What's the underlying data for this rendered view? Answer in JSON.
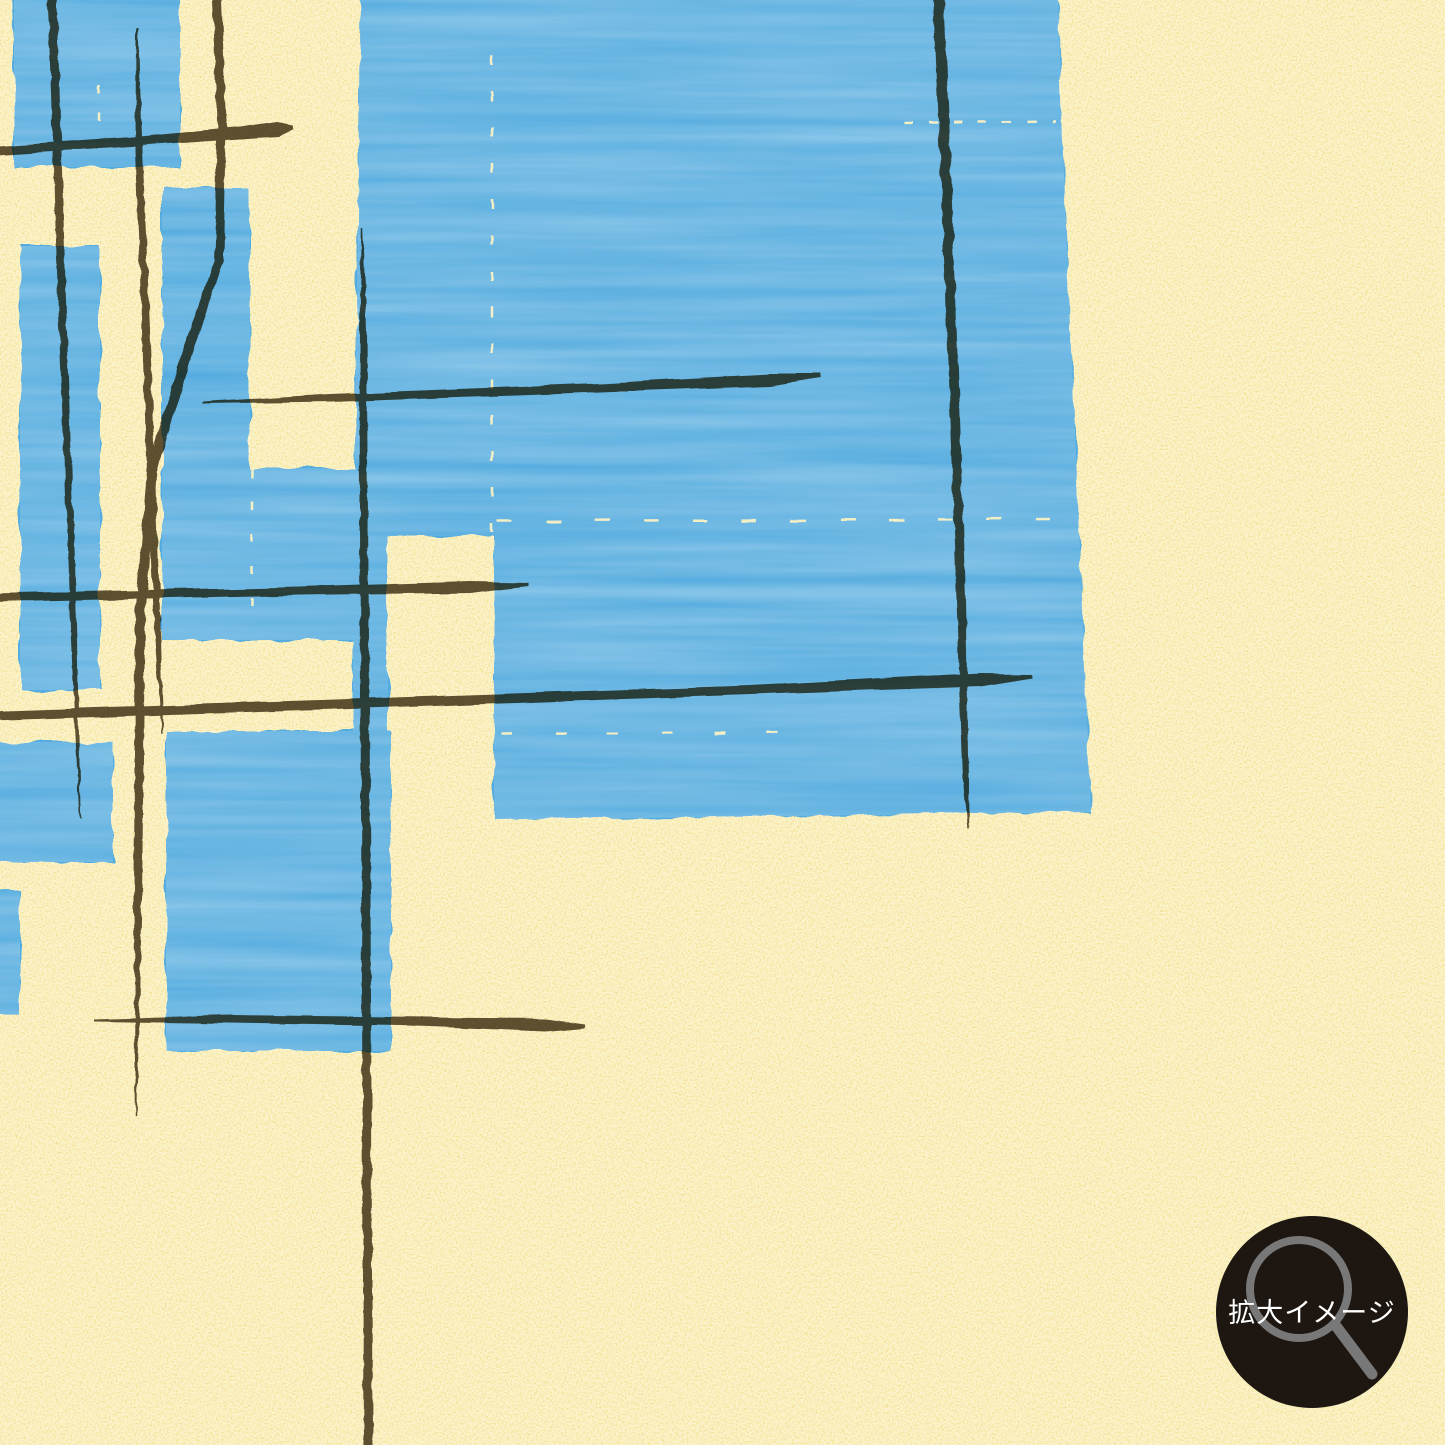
{
  "image": {
    "kind": "abstract-pattern-artwork-enlarged-view"
  },
  "badge": {
    "label": "拡大イメージ",
    "icon": "magnifier-icon",
    "bg_color": "#1e1711",
    "glass_color": "#818181",
    "text_color": "#ffffff",
    "cx": 1312,
    "cy": 1312,
    "r": 96
  },
  "art": {
    "background": "#f0d87c",
    "speckle_light": "#fdf4bc",
    "speckle_dark": "#e2c45e",
    "blue": "#55acdf",
    "line_color": "#5e5440",
    "crack_color": "#fbf2c4",
    "blue_shapes": [
      {
        "name": "blue-field-top-right",
        "d": "M360,-8 L1058,-8 L1065,200 L1075,430 L1083,620 L1091,812 L494,820 L494,536 L388,536 L388,819 L353,819 L353,533 L358,220 Z"
      },
      {
        "name": "blue-rect-top-left",
        "d": "M14,-8 L180,-8 L180,167 L14,167 Z"
      },
      {
        "name": "blue-rect-left-tall",
        "d": "M20,246 L100,246 L100,690 L20,690 Z"
      },
      {
        "name": "blue-rect-center-column",
        "d": "M162,187 L250,187 L250,468 L356,468 L356,640 L162,640 Z"
      },
      {
        "name": "blue-rect-bottom-left",
        "d": "M166,731 L391,731 L391,1051 L166,1051 Z"
      },
      {
        "name": "blue-rect-left-edge",
        "d": "M-8,742 L113,742 L113,862 L-8,862 Z"
      },
      {
        "name": "blue-sliver-left-edge",
        "d": "M-8,889 L20,889 L20,1014 L-8,1014 Z"
      }
    ],
    "brush_lines": [
      {
        "name": "brush-vline-1",
        "pts": [
          [
            52,
            -10,
            9
          ],
          [
            62,
            300,
            8
          ],
          [
            74,
            640,
            6
          ],
          [
            80,
            818,
            1.5
          ]
        ]
      },
      {
        "name": "brush-vline-2",
        "pts": [
          [
            137,
            28,
            2
          ],
          [
            139,
            150,
            7
          ],
          [
            146,
            330,
            8
          ],
          [
            152,
            500,
            8
          ],
          [
            158,
            640,
            6
          ],
          [
            163,
            735,
            1.5
          ]
        ]
      },
      {
        "name": "brush-vline-3",
        "pts": [
          [
            216,
            -10,
            9
          ],
          [
            222,
            120,
            9
          ],
          [
            219,
            260,
            9
          ],
          [
            185,
            360,
            10
          ],
          [
            152,
            470,
            10
          ],
          [
            140,
            620,
            10
          ],
          [
            138,
            900,
            8
          ],
          [
            136,
            1117,
            1.5
          ]
        ]
      },
      {
        "name": "brush-vline-4",
        "pts": [
          [
            362,
            227,
            1.5
          ],
          [
            363,
            330,
            7
          ],
          [
            365,
            700,
            9
          ],
          [
            367,
            1100,
            9
          ],
          [
            368,
            1455,
            9
          ]
        ]
      },
      {
        "name": "brush-vline-5",
        "pts": [
          [
            938,
            -10,
            11
          ],
          [
            950,
            280,
            10
          ],
          [
            961,
            600,
            9
          ],
          [
            966,
            780,
            6
          ],
          [
            968,
            828,
            1.5
          ]
        ]
      },
      {
        "name": "brush-hline-1",
        "pts": [
          [
            -10,
            151,
            8
          ],
          [
            140,
            141,
            9
          ],
          [
            240,
            133,
            11
          ],
          [
            278,
            129,
            14
          ],
          [
            293,
            127,
            4
          ]
        ]
      },
      {
        "name": "brush-hline-2",
        "pts": [
          [
            203,
            403,
            2
          ],
          [
            330,
            398,
            8
          ],
          [
            600,
            388,
            9
          ],
          [
            770,
            380,
            12
          ],
          [
            820,
            376,
            4
          ]
        ]
      },
      {
        "name": "brush-hline-3",
        "pts": [
          [
            -10,
            598,
            8
          ],
          [
            300,
            591,
            8
          ],
          [
            470,
            587,
            11
          ],
          [
            528,
            584,
            3
          ]
        ]
      },
      {
        "name": "brush-hline-4",
        "pts": [
          [
            -10,
            716,
            10
          ],
          [
            350,
            704,
            10
          ],
          [
            750,
            690,
            9
          ],
          [
            980,
            680,
            13
          ],
          [
            1033,
            676,
            4
          ]
        ]
      },
      {
        "name": "brush-hline-5",
        "pts": [
          [
            94,
            1020,
            2
          ],
          [
            230,
            1019,
            8
          ],
          [
            430,
            1022,
            9
          ],
          [
            545,
            1025,
            13
          ],
          [
            584,
            1026,
            4
          ]
        ]
      }
    ],
    "dash_marks": [
      {
        "name": "crack-vertical-1",
        "d": "M492,55 L492,532",
        "dash": "10 26",
        "width": 2.5
      },
      {
        "name": "crack-horizontal-1",
        "d": "M497,521 L1054,519",
        "dash": "15 34",
        "width": 2.5
      },
      {
        "name": "crack-horizontal-2",
        "d": "M903,123 L1056,121",
        "dash": "9 16",
        "width": 2.5
      },
      {
        "name": "crack-horizontal-3",
        "d": "M502,734 L806,732",
        "dash": "11 42",
        "width": 2.5
      },
      {
        "name": "crack-vertical-2",
        "d": "M252,470 L252,612",
        "dash": "8 24",
        "width": 2.5
      },
      {
        "name": "crack-vertical-3",
        "d": "M99,85 L99,130",
        "dash": "9 18",
        "width": 2.5
      }
    ]
  }
}
